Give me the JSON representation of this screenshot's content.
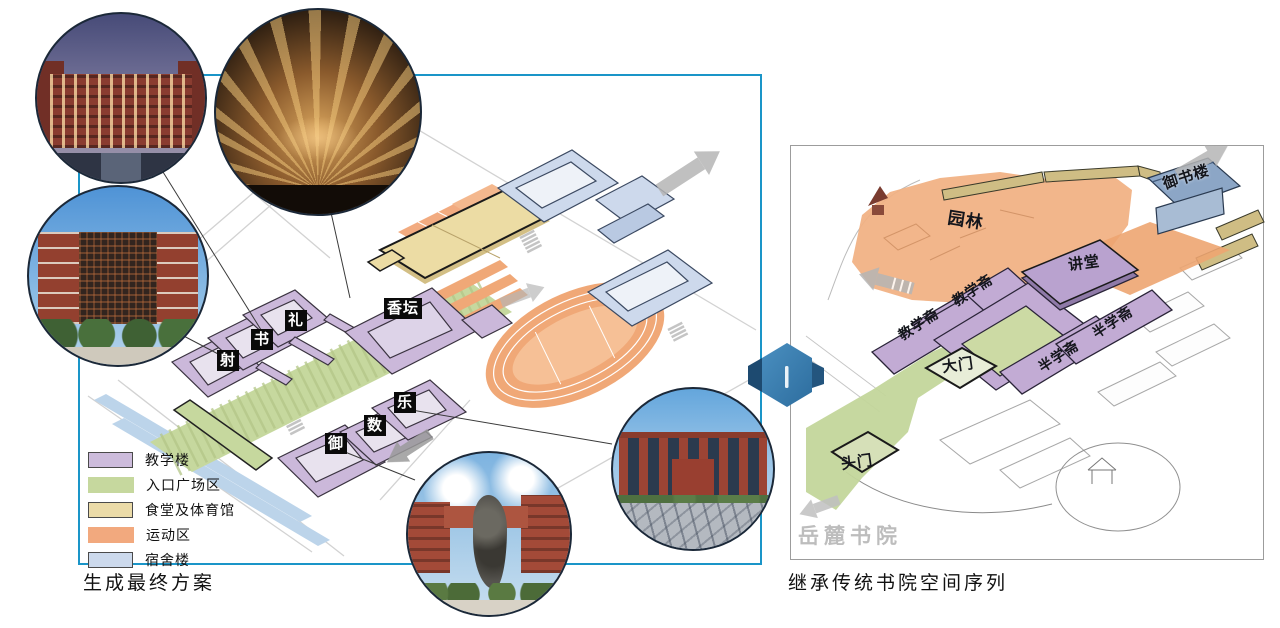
{
  "left_panel": {
    "caption": "生成最终方案",
    "building_labels": {
      "xiangtan": "香坛",
      "li": "礼",
      "shu": "书",
      "she": "射",
      "yu": "御",
      "shu_num": "数",
      "le": "乐"
    },
    "legend": {
      "items": [
        {
          "label": "教学楼",
          "color": "#cdbcdc"
        },
        {
          "label": "入口广场区",
          "color": "#c6d89e"
        },
        {
          "label": "食堂及体育馆",
          "color": "#ebdba8"
        },
        {
          "label": "运动区",
          "color": "#f2a97e"
        },
        {
          "label": "宿舍楼",
          "color": "#ccd9ec"
        }
      ]
    }
  },
  "right_panel": {
    "caption": "继承传统书院空间序列",
    "watermark": "岳麓书院",
    "labels": {
      "garden": "园林",
      "yushulou": "御书楼",
      "jiangtang": "讲堂",
      "jiaoxuezhai_1": "教学斋",
      "jiaoxuezhai_2": "教学斋",
      "banxuezhai_1": "半学斋",
      "banxuezhai_2": "半学斋",
      "damen": "大门",
      "toumen": "头门"
    }
  },
  "colors": {
    "left_panel_border": "#1a95c8",
    "right_panel_border": "#9c9c9c",
    "teaching_purple": "#cdbcdc",
    "plaza_green": "#c6d89e",
    "canteen_yellow": "#ebdba8",
    "sports_orange": "#f2a97e",
    "dorm_blue": "#ccd9ec",
    "connector_blue": "#3f82b0"
  }
}
